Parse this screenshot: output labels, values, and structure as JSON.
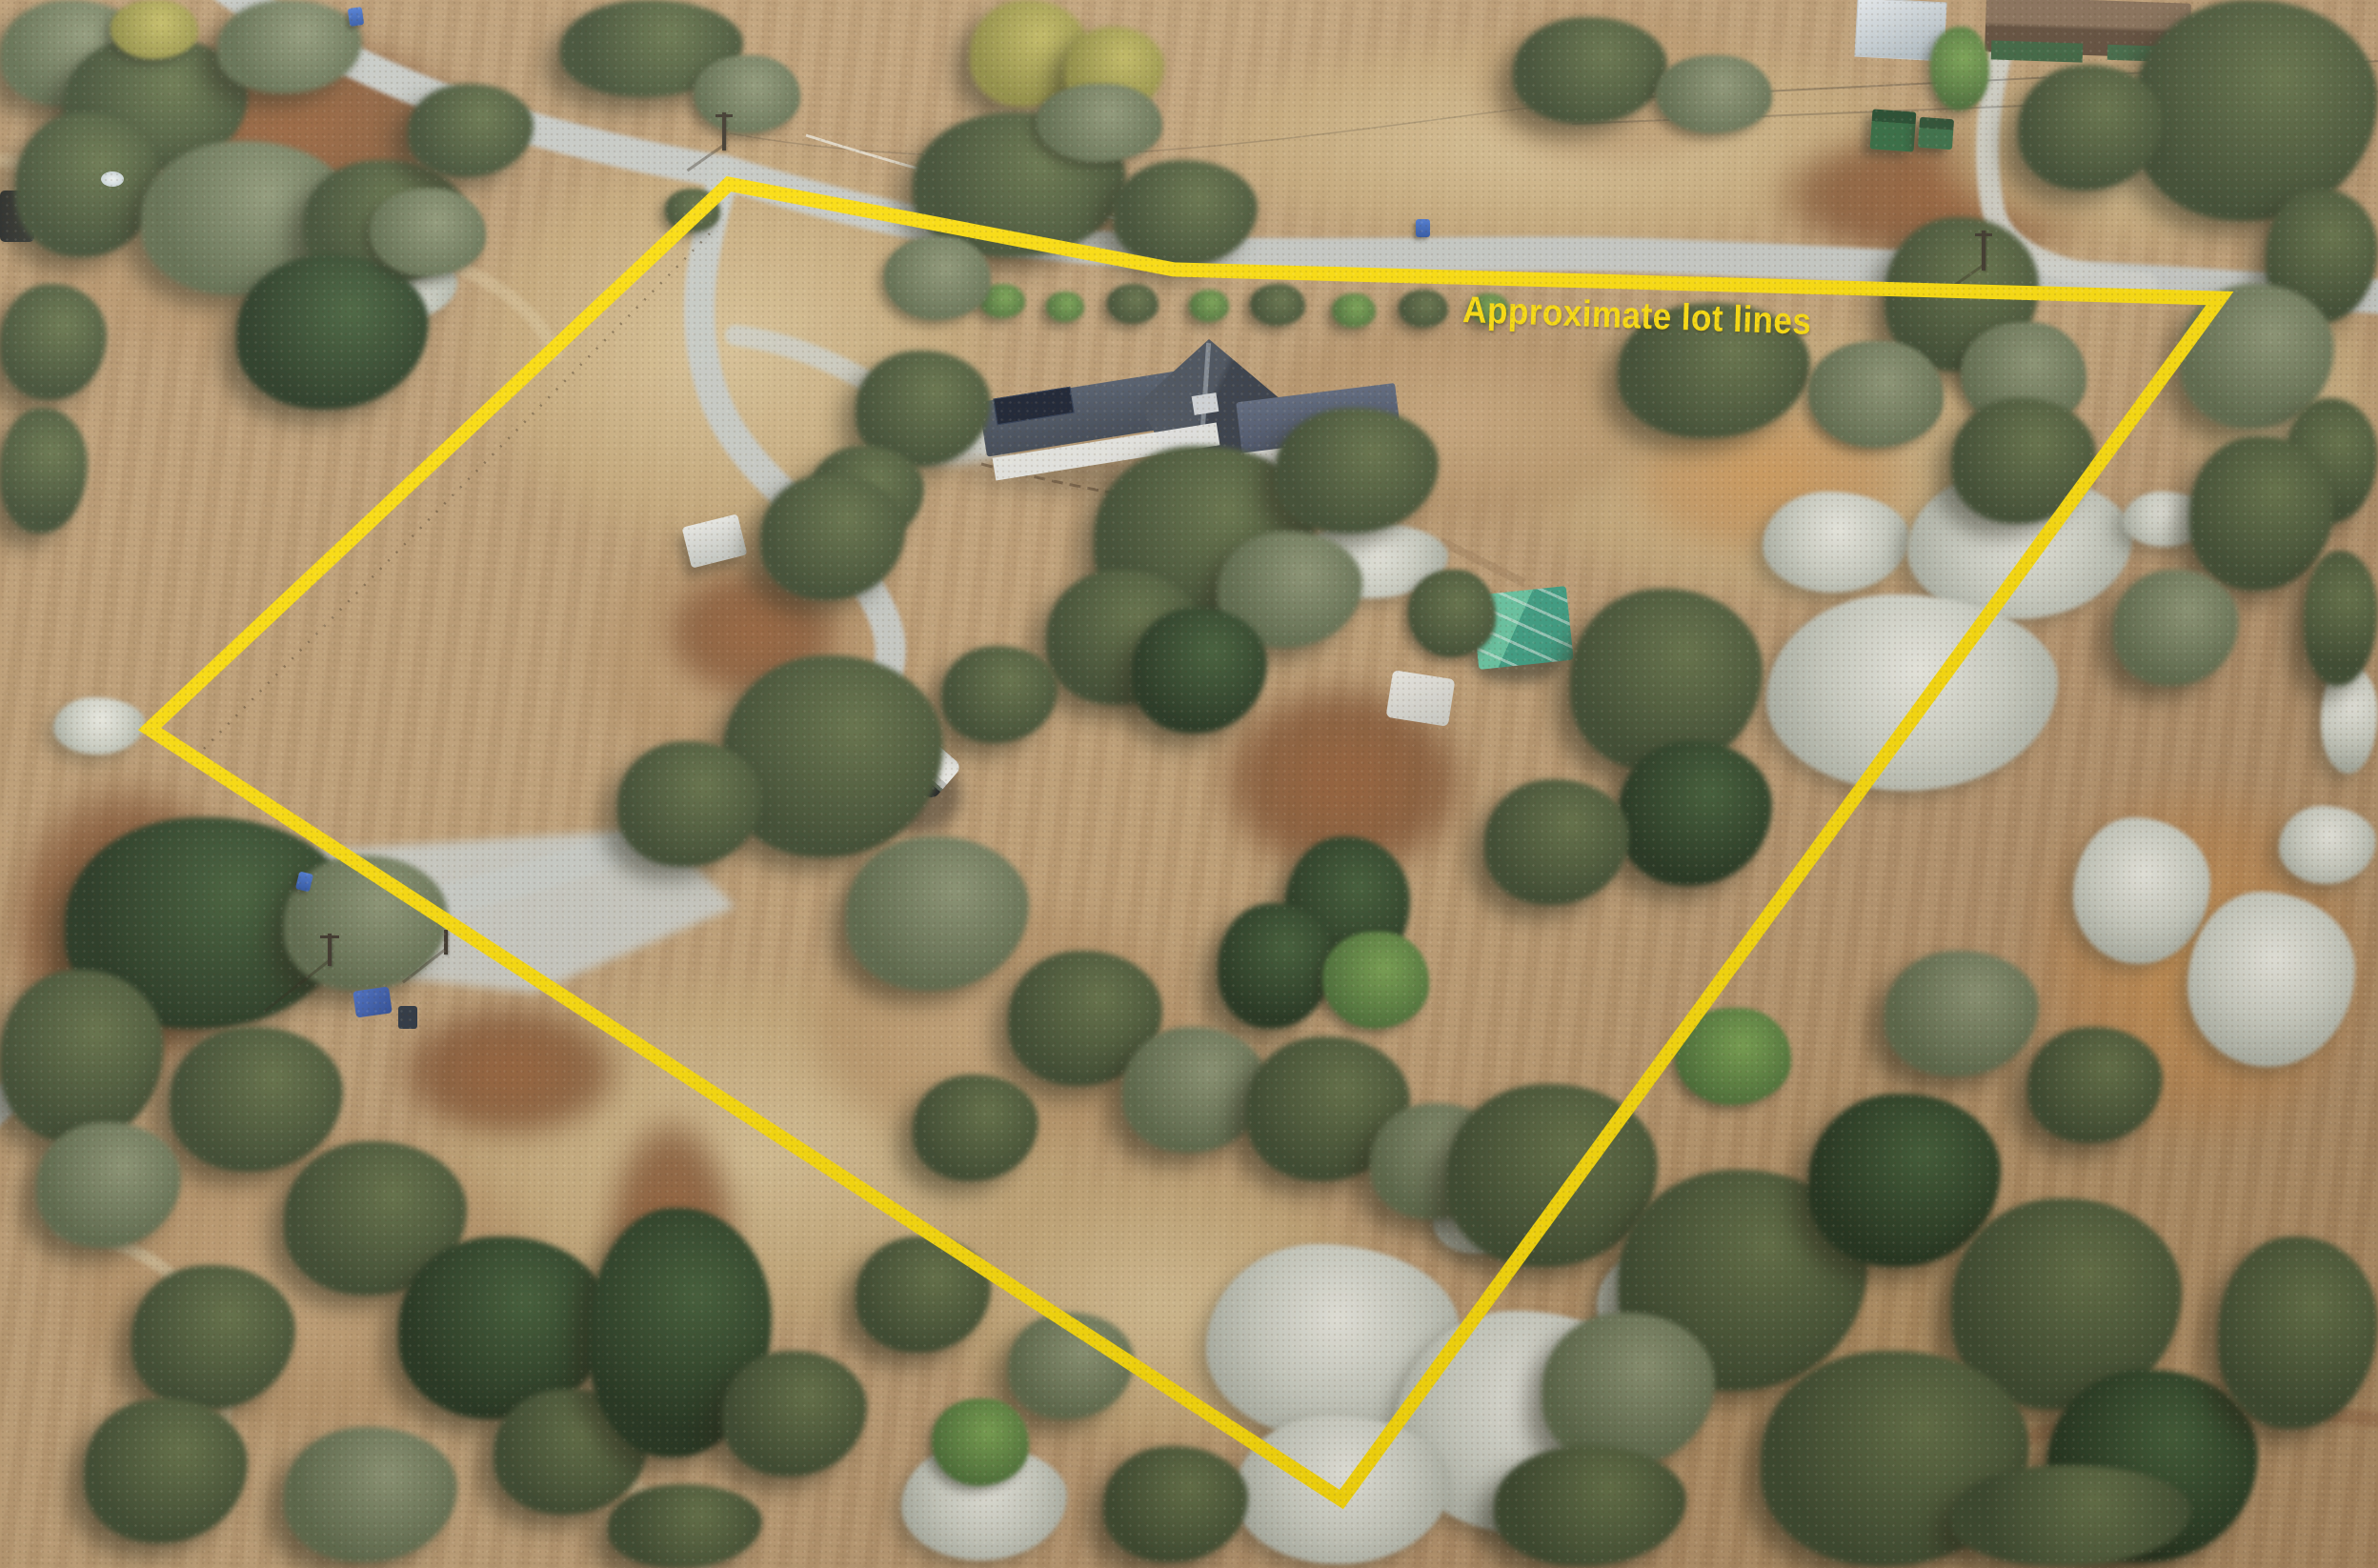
{
  "annotation": {
    "label": "Approximate lot lines"
  },
  "theme": {
    "lot_line_color": "#FFE10A",
    "label_color": "#FFE10A"
  },
  "lot_line": {
    "points_pct": [
      [
        30.65,
        11.73
      ],
      [
        49.36,
        17.19
      ],
      [
        93.35,
        19.02
      ],
      [
        56.41,
        95.63
      ],
      [
        6.29,
        46.48
      ]
    ],
    "stroke_width_px": 15,
    "closed": true
  }
}
